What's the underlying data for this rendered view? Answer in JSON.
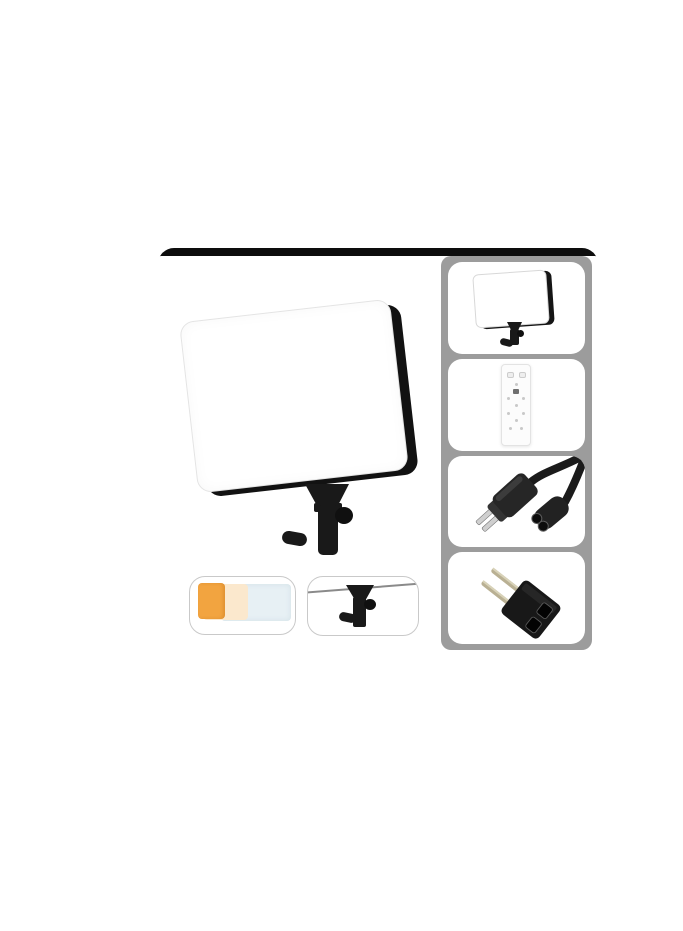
{
  "page": {
    "background": "#ffffff"
  },
  "product_photo": {
    "kind": "e-commerce product image, no text",
    "frame_color": "#0d0d0d",
    "main_view": {
      "label": "LED panel light front view on swivel mount",
      "panel_face_color": "#ffffff",
      "panel_edge_color": "#121212",
      "mount_color": "#191919"
    },
    "detail_boxes": [
      {
        "id": "filters",
        "label": "color filter sheets",
        "colors": {
          "orange": "#f2a440",
          "cream": "#fbe8cd",
          "blue": "#e7f0f4"
        }
      },
      {
        "id": "bracket",
        "label": "mounting bracket close-up"
      }
    ],
    "sidebar": {
      "background": "#9c9c9c",
      "thumbnails": [
        {
          "id": "panel",
          "label": "LED panel light with mount"
        },
        {
          "id": "remote",
          "label": "wireless remote control"
        },
        {
          "id": "cable",
          "label": "power cable with US plug and figure-8 connector"
        },
        {
          "id": "adapter",
          "label": "EU round-pin plug adapter"
        }
      ]
    }
  }
}
